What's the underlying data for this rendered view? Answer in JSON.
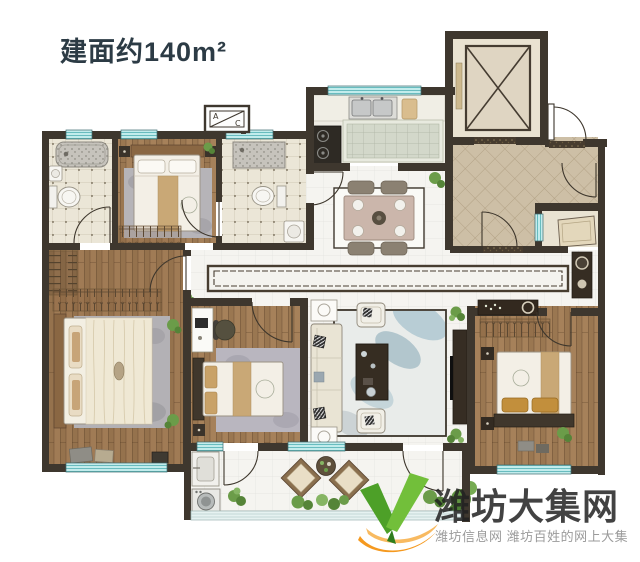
{
  "header": {
    "area_label": "建面约140m²"
  },
  "floorplan": {
    "ac_unit": {
      "letter_a": "A",
      "letter_c": "C"
    }
  },
  "watermark": {
    "site_name": "潍坊大集网",
    "tagline": "潍坊信息网 潍坊百姓的网上大集"
  },
  "colors": {
    "wall": "#3e372e",
    "window_glass": "#c2ecec",
    "wood_floor": "#a6815a",
    "tile_light": "#f5f4f0",
    "tile_beige": "#ebe6d7",
    "foyer_tile": "#cdbfa6",
    "logo_green": "#58a82e",
    "logo_orange": "#f5991f",
    "title_text": "#2c3b45",
    "watermark_text": "#2a2a2a",
    "tagline_text": "#9b9b9b"
  }
}
